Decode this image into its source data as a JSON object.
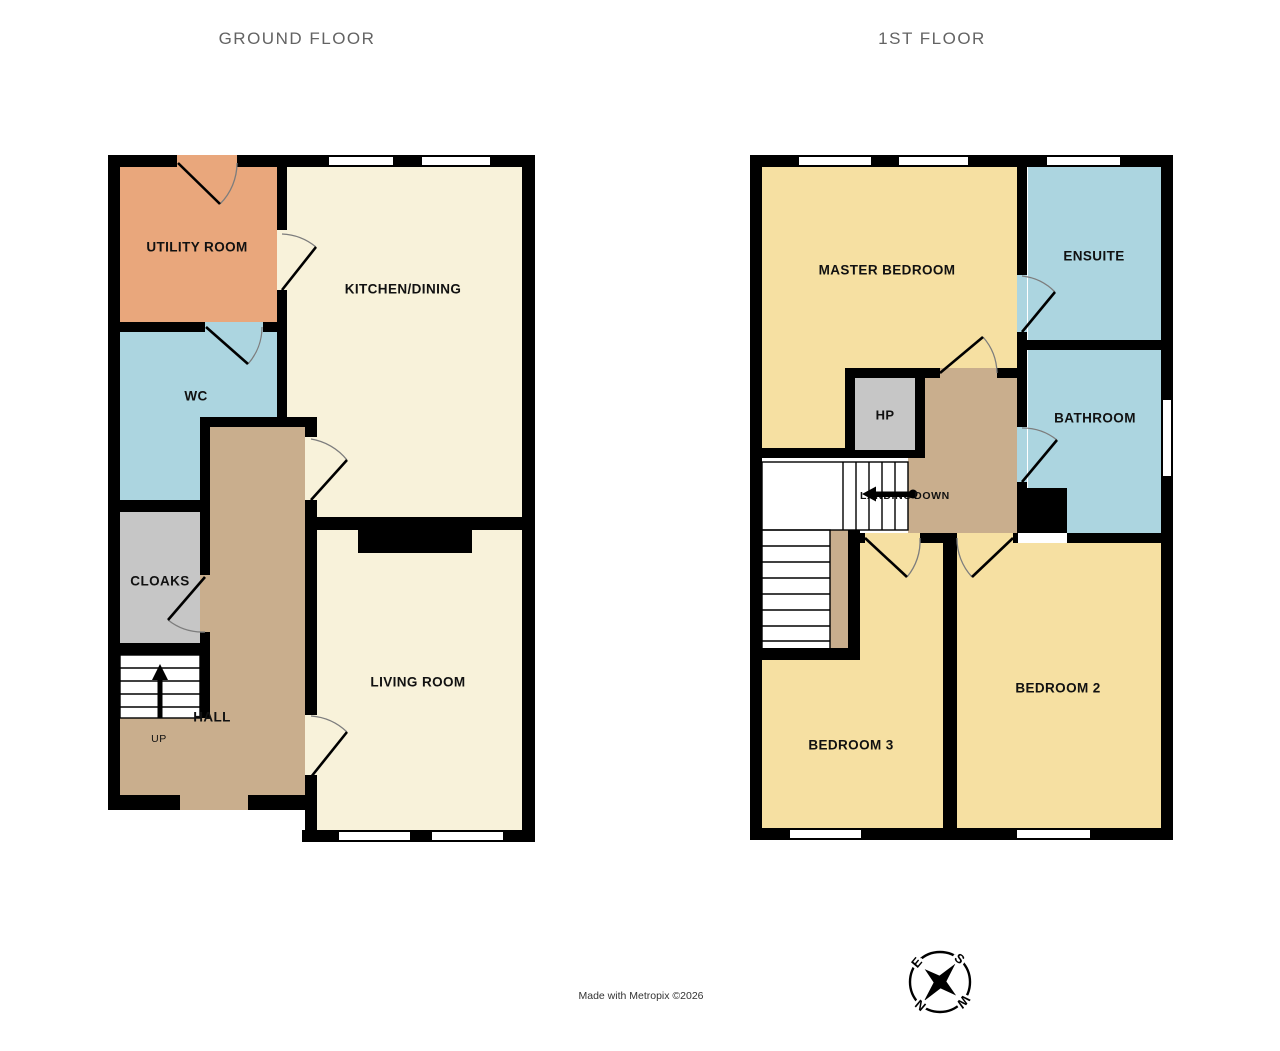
{
  "titles": {
    "ground_floor": "GROUND FLOOR",
    "first_floor": "1ST FLOOR"
  },
  "labels": {
    "utility": "UTILITY ROOM",
    "kitchen": "KITCHEN/DINING",
    "wc": "WC",
    "cloaks": "CLOAKS",
    "hall": "HALL",
    "up": "UP",
    "living": "LIVING ROOM",
    "master": "MASTER BEDROOM",
    "ensuite": "ENSUITE",
    "bathroom": "BATHROOM",
    "hp": "HP",
    "landing": "LANDING",
    "down": "DOWN",
    "bedroom2": "BEDROOM 2",
    "bedroom3": "BEDROOM 3"
  },
  "footer": {
    "credit": "Made with Metropix ©2026"
  },
  "compass": {
    "n": "N",
    "e": "E",
    "s": "S",
    "w": "W"
  },
  "floors": [
    {
      "name": "GROUND FLOOR",
      "rooms": [
        "UTILITY ROOM",
        "KITCHEN/DINING",
        "WC",
        "CLOAKS",
        "HALL",
        "LIVING ROOM"
      ]
    },
    {
      "name": "1ST FLOOR",
      "rooms": [
        "MASTER BEDROOM",
        "ENSUITE",
        "BATHROOM",
        "LANDING",
        "BEDROOM 2",
        "BEDROOM 3"
      ]
    }
  ],
  "colors": {
    "wall": "#000000",
    "kitchen_living_floor": "#F8F2DA",
    "utility_floor": "#E9A77C",
    "wet_room_floor": "#ACD5E0",
    "hall_landing_floor": "#C9AE8D",
    "cloaks_hp_floor": "#C6C6C6",
    "bedroom_floor": "#F6E0A2",
    "title_text": "#636363",
    "label_text": "#111111",
    "door_arc": "#7d7d7d"
  }
}
